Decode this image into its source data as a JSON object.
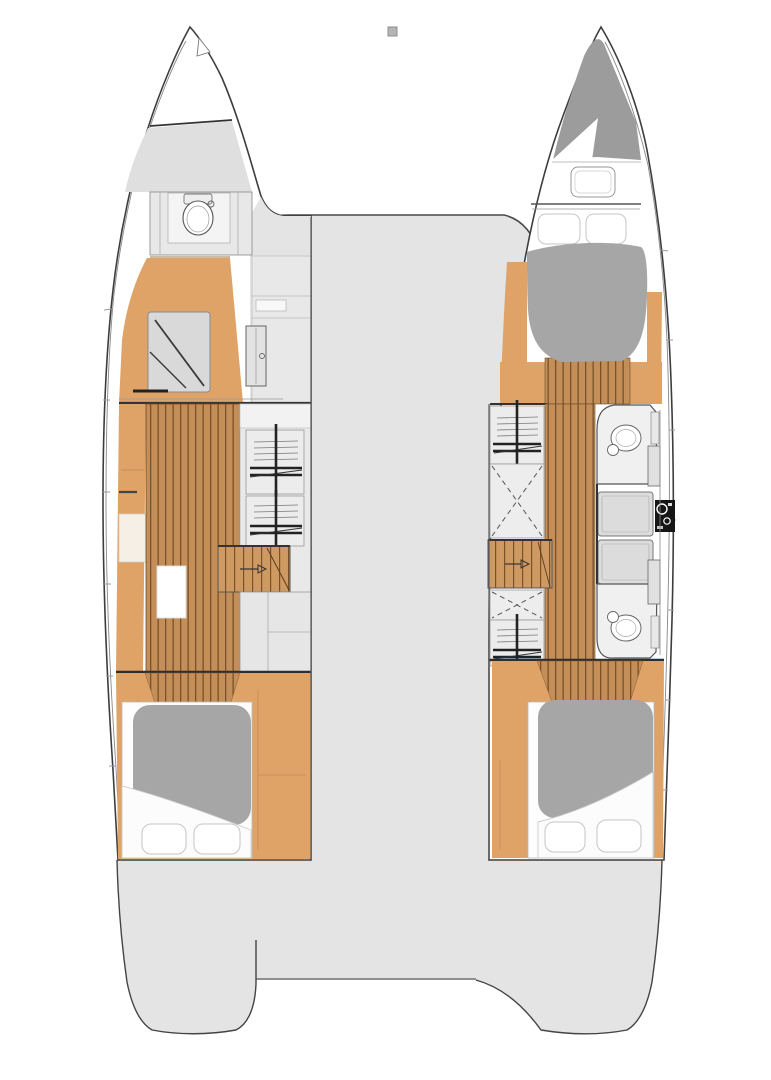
{
  "document": {
    "type": "boat-floor-plan",
    "subject": "Catamaran interior layout plan, top view, two hulls with cabins and bridge deck",
    "visible_text": ""
  },
  "canvas": {
    "width": 771,
    "height": 1080,
    "background": "#ffffff"
  },
  "colors": {
    "outline": "#3d3d3d",
    "lineDark": "#2e2e2e",
    "furniture": "#555555",
    "band": "#888888",
    "deck": "#dfdfdf",
    "bridge": "#e4e4e4",
    "wall": "#ececec",
    "panel": "#dcdcdc",
    "wood": "#c38e58",
    "woodDark": "#7a5128",
    "woodLight": "#cf9a61",
    "floorTan": "#dfa368",
    "floorTanLight": "#e9b77e",
    "mattress": "#a6a6a6",
    "bowShade": "#9c9c9c",
    "sheet": "#fcfcfc",
    "consoleBlack": "#161616",
    "marker": "#b5b5b5",
    "white": "#ffffff"
  },
  "marker": {
    "x": 388,
    "y": 27,
    "size": 9
  },
  "left_hull": {
    "features": [
      "bow-anchor-locker",
      "foredeck",
      "toilet-room",
      "shower-room",
      "shelf-units",
      "companionway-stairs",
      "storage-cabinets",
      "aft-double-bed-cabin"
    ]
  },
  "right_hull": {
    "features": [
      "bow-anchor-locker",
      "foredeck-hatch",
      "forward-double-bed-cabin",
      "shelf-unit",
      "wardrobe",
      "companionway-stairs",
      "wardrobe",
      "shelf-unit",
      "forward-bathroom-toilet",
      "shower-panels",
      "sink-console",
      "aft-bathroom-toilet",
      "aft-double-bed-cabin"
    ]
  },
  "bridge_deck": {
    "features": [
      "center-bridge-deck",
      "port-stern-platform",
      "starboard-stern-platform"
    ]
  }
}
